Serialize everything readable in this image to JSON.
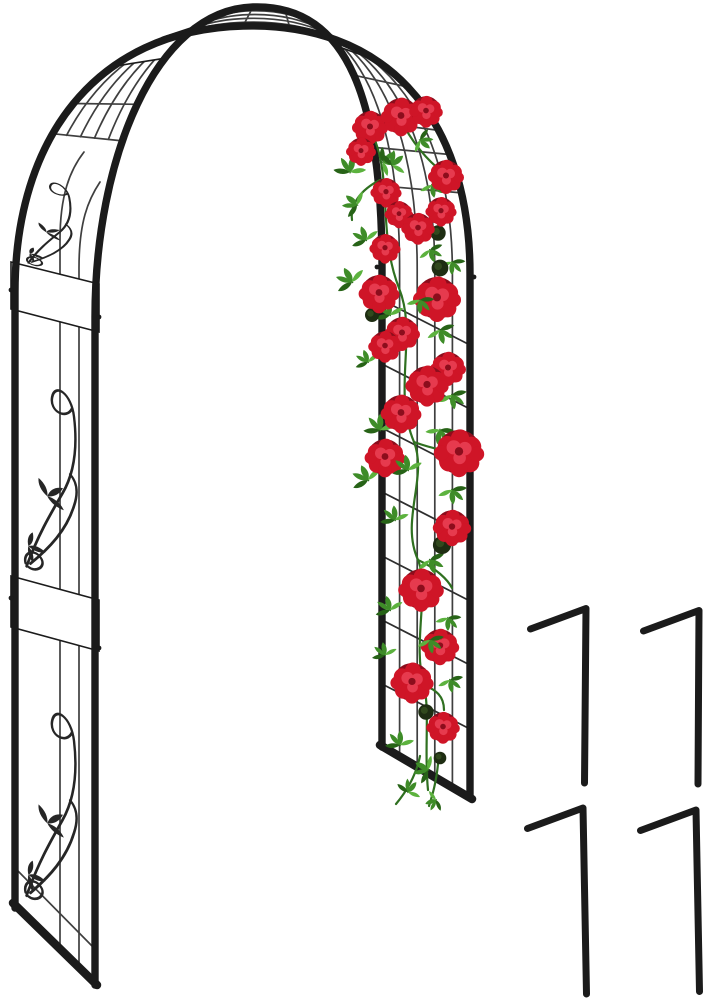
{
  "scene": {
    "description": "Black metal garden arch arbor with decorative scrollwork pillars, lattice trellis, climbing red rose vine, and four ground anchor stakes",
    "background": "#ffffff"
  },
  "colors": {
    "bg": "#ffffff",
    "frame": "#1b1b1b",
    "iron": "#262626",
    "wire": "#3f3f3f",
    "grid": "#2e2e2e",
    "rose-dark": "#8c0d1c",
    "rose-mid": "#cf1527",
    "rose-light": "#e63a4e",
    "leaf-main": "#3e8c28",
    "leaf-dark": "#276317",
    "leaf-light": "#5cb23e",
    "stem": "#2f7020",
    "bud": "#1e2d12",
    "bud-light": "#31491d"
  },
  "counts": {
    "stakes": 4,
    "roses": 22,
    "buds": 6
  },
  "roses": [
    [
      370,
      127,
      1.5
    ],
    [
      401,
      116,
      1.7
    ],
    [
      426,
      111,
      1.4
    ],
    [
      361,
      151,
      1.25
    ],
    [
      446,
      176,
      1.5
    ],
    [
      386,
      192,
      1.3
    ],
    [
      399,
      214,
      1.2
    ],
    [
      441,
      211,
      1.3
    ],
    [
      418,
      228,
      1.4
    ],
    [
      385,
      248,
      1.3
    ],
    [
      379,
      293,
      1.7
    ],
    [
      437,
      298,
      2.0
    ],
    [
      402,
      333,
      1.5
    ],
    [
      385,
      346,
      1.4
    ],
    [
      448,
      368,
      1.5
    ],
    [
      427,
      385,
      1.8
    ],
    [
      401,
      413,
      1.7
    ],
    [
      385,
      457,
      1.7
    ],
    [
      459,
      452,
      2.1
    ],
    [
      452,
      527,
      1.6
    ],
    [
      421,
      589,
      1.9
    ],
    [
      440,
      646,
      1.6
    ],
    [
      412,
      682,
      1.8
    ],
    [
      443,
      727,
      1.4
    ]
  ],
  "buds": [
    [
      438,
      233,
      1.1
    ],
    [
      440,
      268,
      1.2
    ],
    [
      372,
      315,
      1.0
    ],
    [
      442,
      545,
      1.3
    ],
    [
      426,
      712,
      1.1
    ],
    [
      440,
      758,
      0.9
    ]
  ],
  "leaves": [
    [
      350,
      172,
      -140,
      1.0
    ],
    [
      383,
      162,
      -60,
      0.9
    ],
    [
      420,
      140,
      -20,
      0.8
    ],
    [
      357,
      205,
      160,
      0.9
    ],
    [
      432,
      185,
      20,
      0.8
    ],
    [
      366,
      240,
      -170,
      0.9
    ],
    [
      430,
      250,
      10,
      0.8
    ],
    [
      352,
      282,
      180,
      1.0
    ],
    [
      452,
      262,
      30,
      0.8
    ],
    [
      390,
      315,
      200,
      0.9
    ],
    [
      440,
      330,
      15,
      0.9
    ],
    [
      368,
      362,
      190,
      0.8
    ],
    [
      452,
      395,
      20,
      0.9
    ],
    [
      380,
      430,
      210,
      1.0
    ],
    [
      440,
      430,
      40,
      0.9
    ],
    [
      368,
      480,
      185,
      1.0
    ],
    [
      452,
      490,
      25,
      0.9
    ],
    [
      395,
      520,
      205,
      0.9
    ],
    [
      430,
      560,
      10,
      0.9
    ],
    [
      390,
      610,
      195,
      0.9
    ],
    [
      448,
      618,
      30,
      0.8
    ],
    [
      385,
      655,
      200,
      0.8
    ],
    [
      450,
      680,
      20,
      0.8
    ],
    [
      400,
      745,
      210,
      0.9
    ],
    [
      428,
      770,
      150,
      0.9
    ],
    [
      408,
      792,
      250,
      0.8
    ],
    [
      436,
      800,
      100,
      0.7
    ]
  ],
  "leaves_front": [
    [
      392,
      165,
      -100,
      0.9
    ],
    [
      420,
      300,
      30,
      0.85
    ],
    [
      408,
      470,
      200,
      0.95
    ],
    [
      430,
      640,
      20,
      0.85
    ]
  ],
  "stakes": [
    {
      "arm": [
        530.5,
        629
      ],
      "bend": [
        586,
        608.5
      ],
      "foot": [
        584.5,
        783
      ]
    },
    {
      "arm": [
        643.5,
        631
      ],
      "bend": [
        699,
        610.5
      ],
      "foot": [
        698,
        784
      ]
    },
    {
      "arm": [
        527.5,
        828.5
      ],
      "bend": [
        583,
        808
      ],
      "foot": [
        586.5,
        994
      ]
    },
    {
      "arm": [
        640.5,
        830.5
      ],
      "bend": [
        696,
        810
      ],
      "foot": [
        699.5,
        991.5
      ]
    }
  ]
}
